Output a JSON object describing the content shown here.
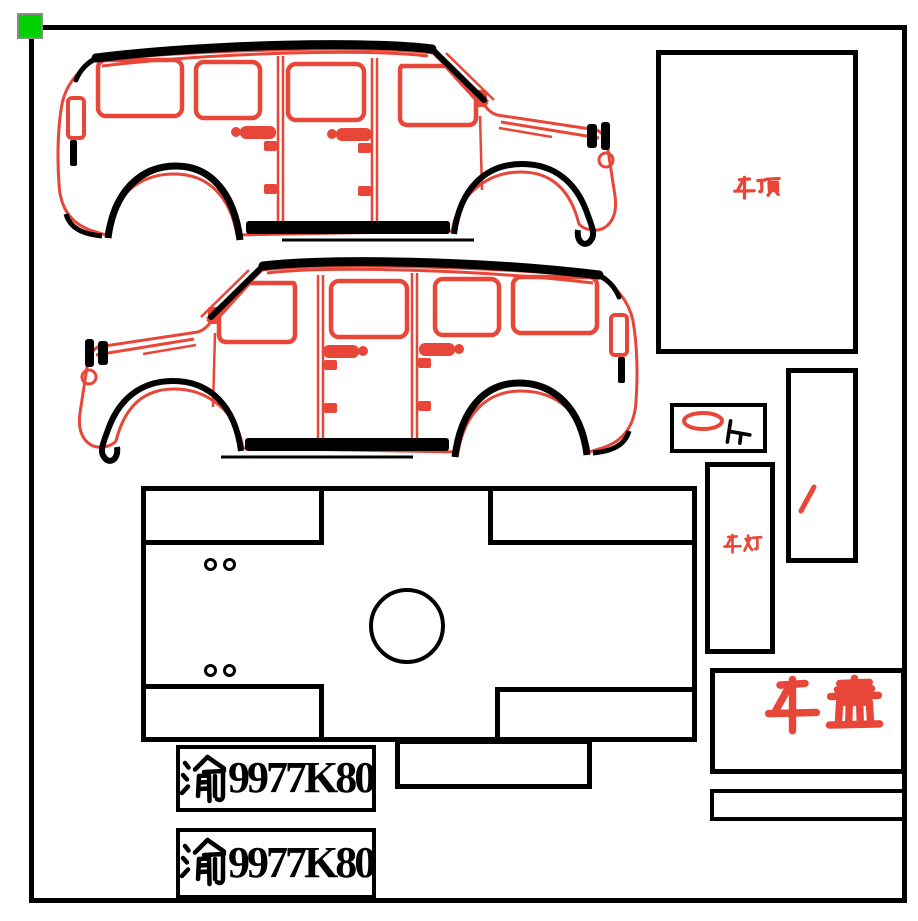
{
  "colors": {
    "red": "#e74638",
    "black": "#000000",
    "green": "#00d000",
    "background": "#ffffff"
  },
  "labels": {
    "roof": "车顶",
    "lamp": "车灯",
    "hood": "车盖",
    "up": "上",
    "slash": "/"
  },
  "plates": [
    {
      "prefix": "渝",
      "number": "9977K80"
    },
    {
      "prefix": "渝",
      "number": "9977K80"
    }
  ],
  "icons": {
    "corner_marker": "green-selection-handle",
    "vehicle_top": "jeep-wrangler-side-view-facing-right",
    "vehicle_middle": "jeep-wrangler-side-view-facing-left",
    "up_ring": "red-ellipse-ring"
  }
}
